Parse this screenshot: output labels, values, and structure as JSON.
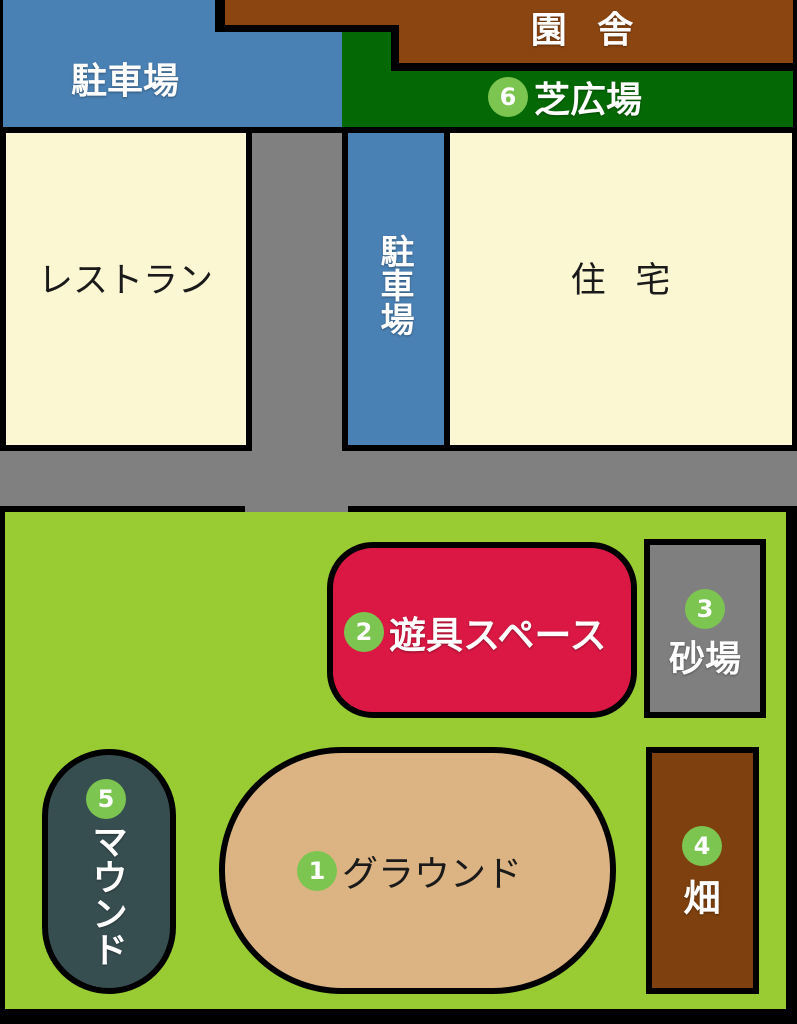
{
  "map": {
    "kind": "facility-grounds-map",
    "colors": {
      "background_line": "#000000",
      "parking_blue": "#4A81B4",
      "building_brown": "#8B4511",
      "lawn_dark_green": "#046904",
      "cream_building": "#FBF7D3",
      "road_gray": "#808080",
      "field_green": "#98CC32",
      "equipment_red": "#DA1843",
      "sandbox_gray": "#7F7F7F",
      "ground_tan": "#DCB483",
      "mound_teal": "#374E51",
      "crop_field_brown": "#7E400E",
      "badge_green": "#7CC551"
    },
    "areas": {
      "parking_top": {
        "label": "駐車場"
      },
      "building": {
        "label": "園舎"
      },
      "lawn": {
        "number": "6",
        "label": "芝広場"
      },
      "restaurant": {
        "label": "レストラン"
      },
      "parking_center": {
        "label": "駐車場"
      },
      "housing": {
        "label": "住宅"
      },
      "ground": {
        "number": "1",
        "label": "グラウンド"
      },
      "equipment": {
        "number": "2",
        "label": "遊具スペース"
      },
      "sandbox": {
        "number": "3",
        "label": "砂場"
      },
      "crop_field": {
        "number": "4",
        "label": "畑"
      },
      "mound": {
        "number": "5",
        "label": "マウンド"
      }
    }
  }
}
